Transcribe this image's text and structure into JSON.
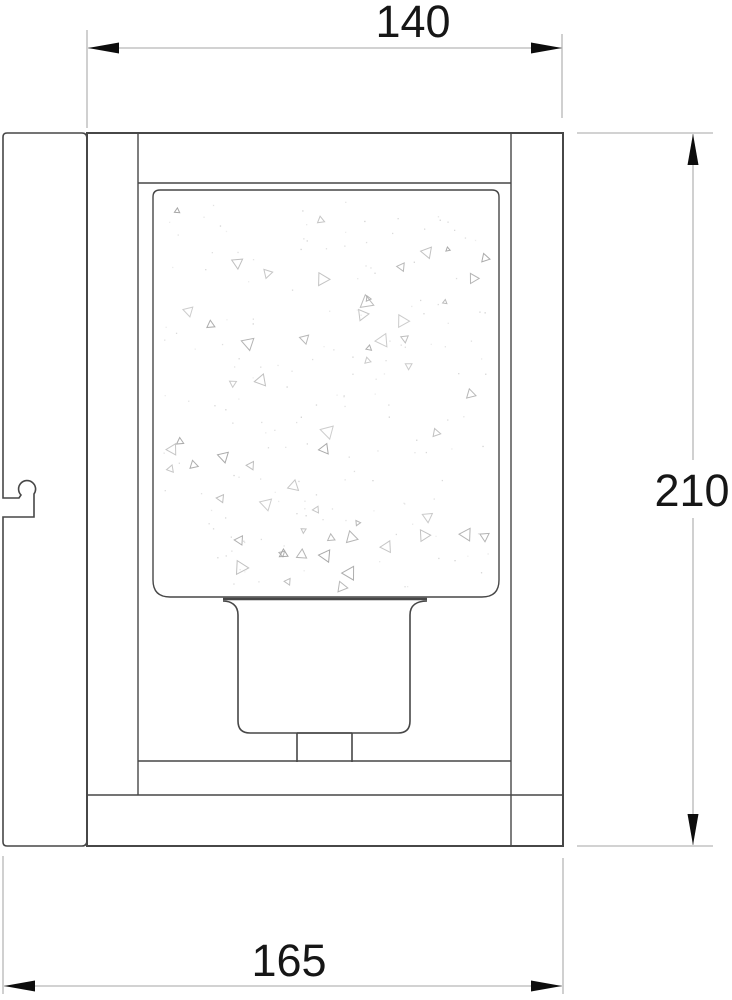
{
  "drawing": {
    "type": "technical-dimension-drawing",
    "subject": "wall-sconce-side-elevation",
    "dimensions": {
      "top": "140",
      "right": "210",
      "bottom": "165"
    },
    "colors": {
      "background": "#ffffff",
      "outline": "#474747",
      "dim_line": "#b7b7b7",
      "arrow": "#0d0d0d",
      "text": "#161616",
      "texture": "#a6a6a6",
      "dot": "#cccccc"
    },
    "glass_texture": {
      "triangle_count": 58,
      "dot_count": 170,
      "region": {
        "x": 163,
        "y": 200,
        "w": 326,
        "h": 388
      }
    }
  }
}
